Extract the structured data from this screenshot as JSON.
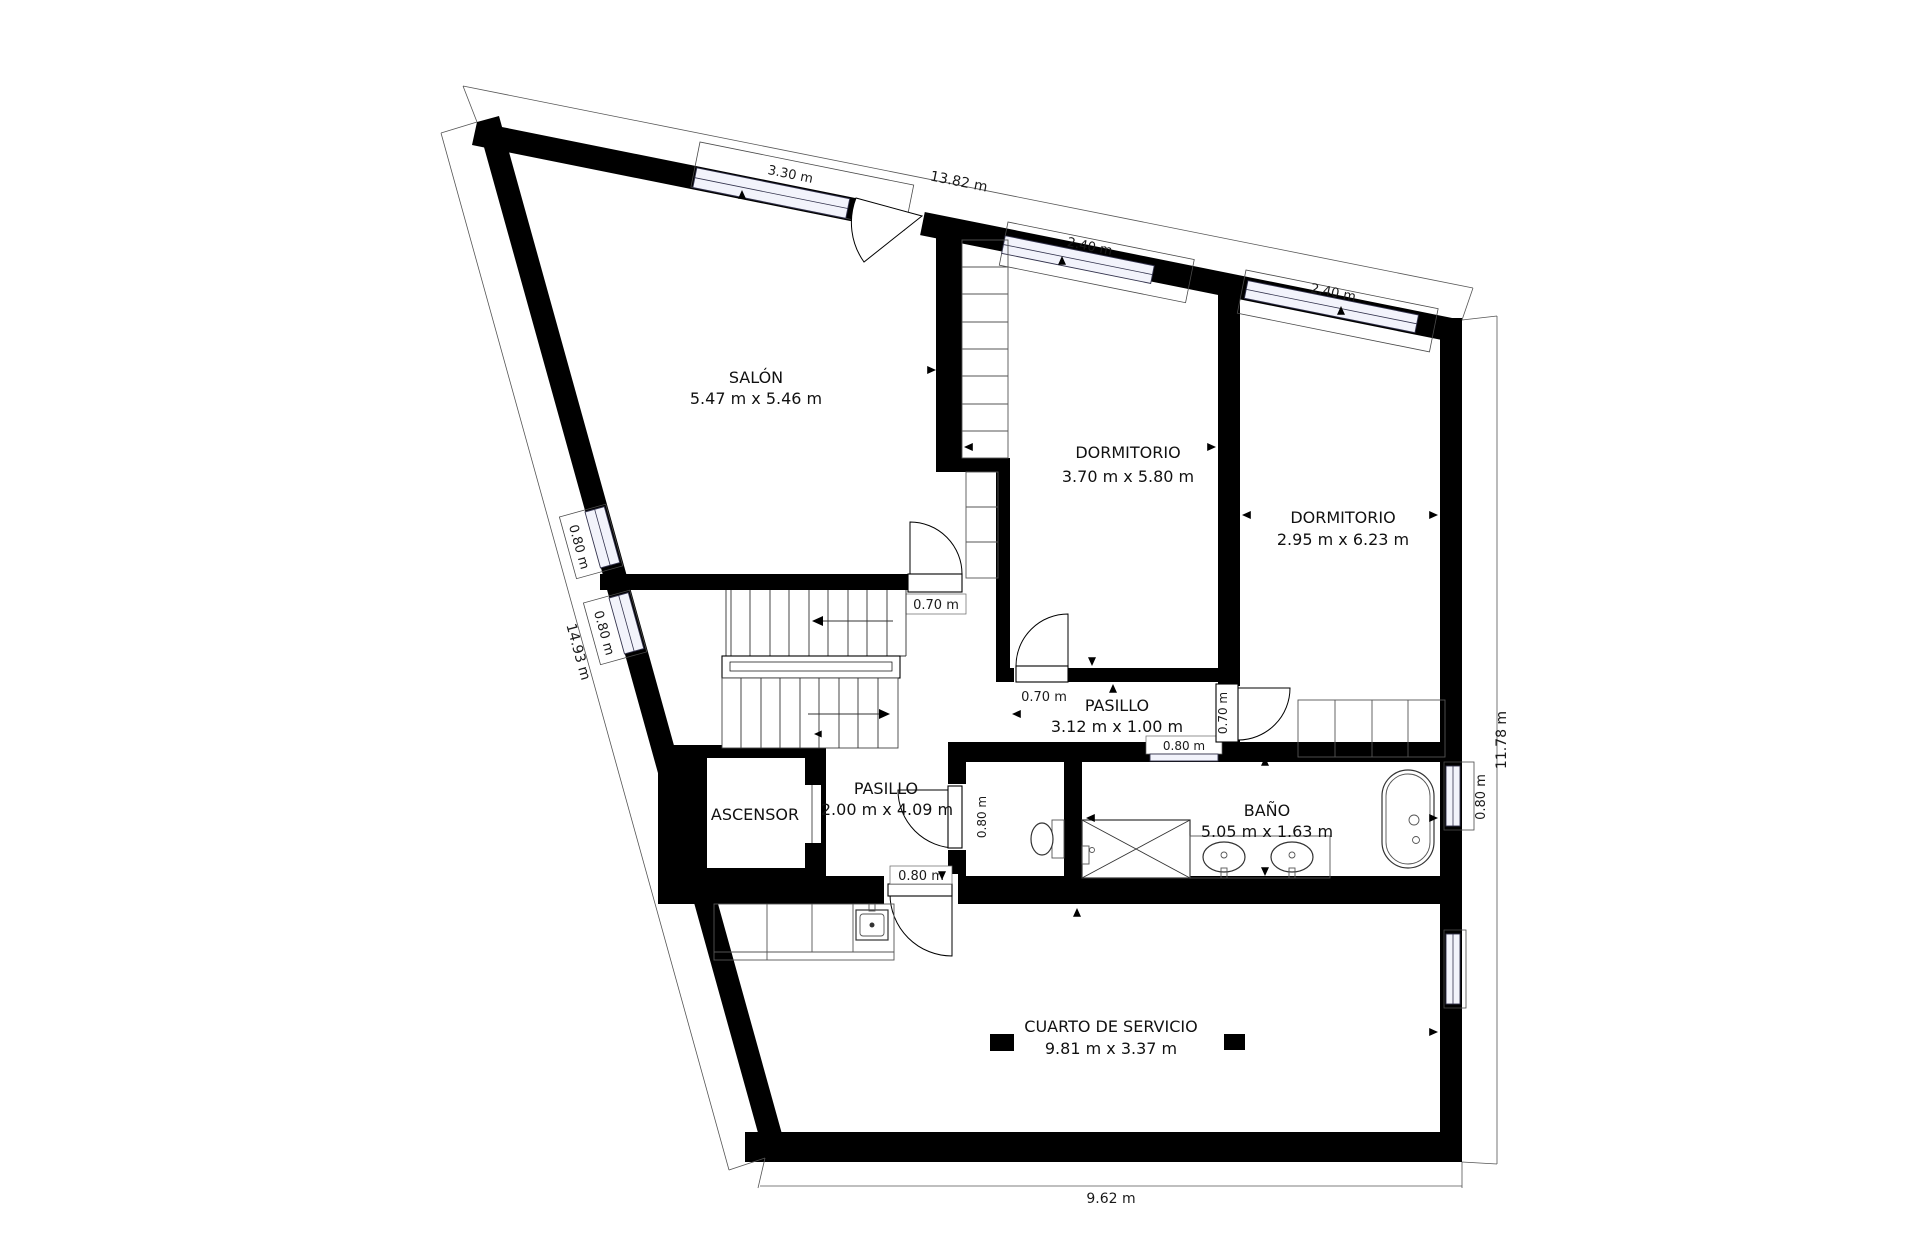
{
  "rooms": [
    {
      "name": "SALÓN",
      "dims": "5.47 m x 5.46 m"
    },
    {
      "name": "DORMITORIO",
      "dims": "3.70 m x 5.80 m"
    },
    {
      "name": "DORMITORIO",
      "dims": "2.95 m x 6.23 m"
    },
    {
      "name": "PASILLO",
      "dims": "3.12 m x 1.00 m"
    },
    {
      "name": "PASILLO",
      "dims": "2.00 m x 4.09 m"
    },
    {
      "name": "ASCENSOR",
      "dims": ""
    },
    {
      "name": "BAÑO",
      "dims": "5.05 m x 1.63 m"
    },
    {
      "name": "CUARTO DE SERVICIO",
      "dims": "9.81 m x 3.37 m"
    }
  ],
  "dimensions": {
    "top_total": "13.82 m",
    "top_window_1": "3.30 m",
    "top_window_2": "2.40 m",
    "top_window_3": "2.40 m",
    "left_total": "14.93 m",
    "left_window_1": "0.80 m",
    "left_window_2": "0.80 m",
    "right_total": "11.78 m",
    "bottom_total": "9.62 m",
    "door_salon": "0.70 m",
    "door_dormitorio_1": "0.70 m",
    "door_dormitorio_2": "0.70 m",
    "door_bathroom_hall": "0.80 m",
    "door_service_room": "0.80 m",
    "bathroom_interior_window": "0.80 m",
    "bathroom_exterior_window": "0.80 m"
  },
  "colors": {
    "wall": "#000000",
    "glazing": "#f2f3fb",
    "background": "#ffffff"
  }
}
